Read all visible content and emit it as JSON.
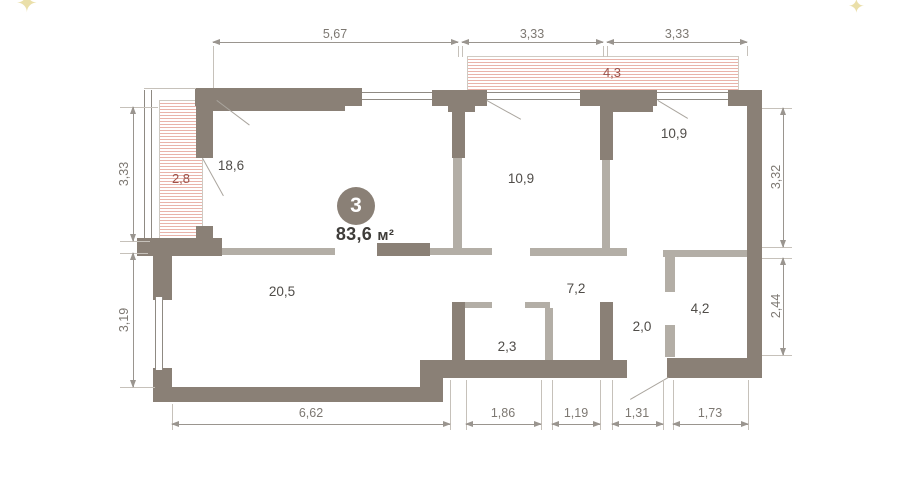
{
  "plan": {
    "badge": {
      "number": "3",
      "area": "83,6",
      "unit": "м²"
    },
    "rooms": [
      {
        "id": "room-top-left",
        "area": "18,6"
      },
      {
        "id": "room-mid",
        "area": "10,9"
      },
      {
        "id": "room-top-right",
        "area": "10,9"
      },
      {
        "id": "room-bottom-left",
        "area": "20,5"
      },
      {
        "id": "corridor",
        "area": "7,2"
      },
      {
        "id": "bathroom",
        "area": "2,3"
      },
      {
        "id": "hall",
        "area": "2,0"
      },
      {
        "id": "wardrobe",
        "area": "4,2"
      }
    ],
    "balconies": [
      {
        "id": "loggia-left",
        "area": "2,8"
      },
      {
        "id": "loggia-top",
        "area": "4,3"
      }
    ],
    "dimensions": {
      "top": [
        "5,67",
        "3,33",
        "3,33"
      ],
      "bottom": [
        "6,62",
        "1,86",
        "1,19",
        "1,31",
        "1,73"
      ],
      "left": [
        "3,33",
        "3,19"
      ],
      "right": [
        "3,32",
        "2,44"
      ]
    },
    "colors": {
      "bg": "#ffffff",
      "wall-dark": "#8a8076",
      "wall-light": "#b3aea6",
      "win": "#8f8a83",
      "stripe": "#e9b3aa",
      "hatch-label": "#9c524a",
      "dim": "#9a958f",
      "dim-text": "#7d7872",
      "wit": "#c6c1ba",
      "swing": "#aaa59e",
      "room-text": "#504d49",
      "badge-bg": "#8a8076",
      "badge-text": "#ffffff",
      "area-text": "#3e3c39",
      "sparkle": "#eadfa9"
    }
  }
}
